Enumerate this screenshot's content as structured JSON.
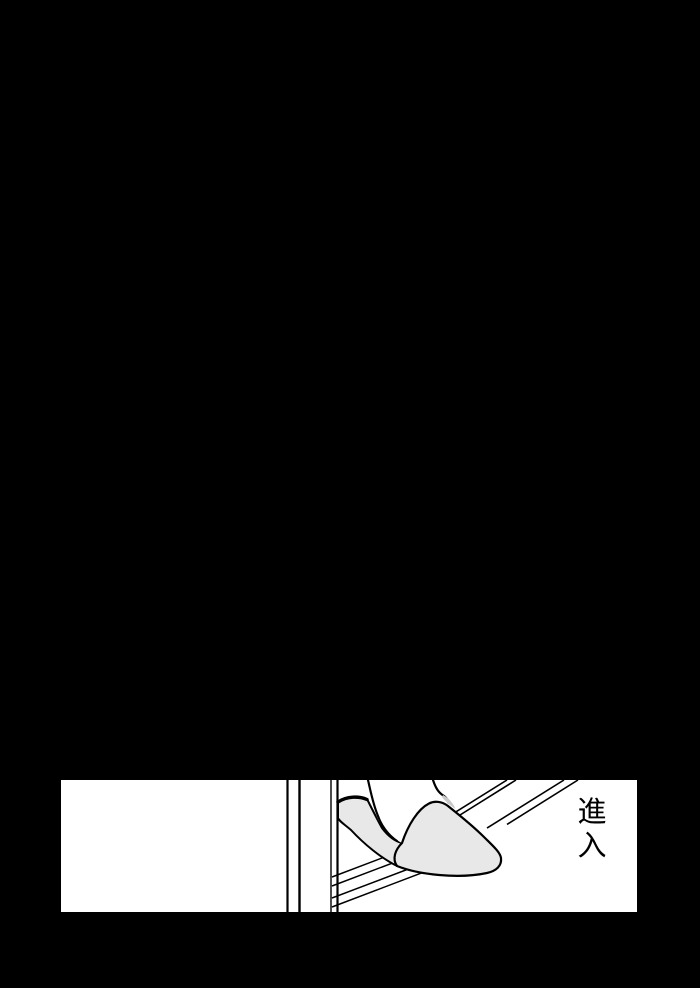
{
  "colors": {
    "page_background": "#000000",
    "paper": "#ffffff",
    "ink": "#000000",
    "slipper_fill": "#e8e8e8",
    "ankle_shadow_fill": "#c9c9c9"
  },
  "panel": {
    "caption": "進入"
  }
}
